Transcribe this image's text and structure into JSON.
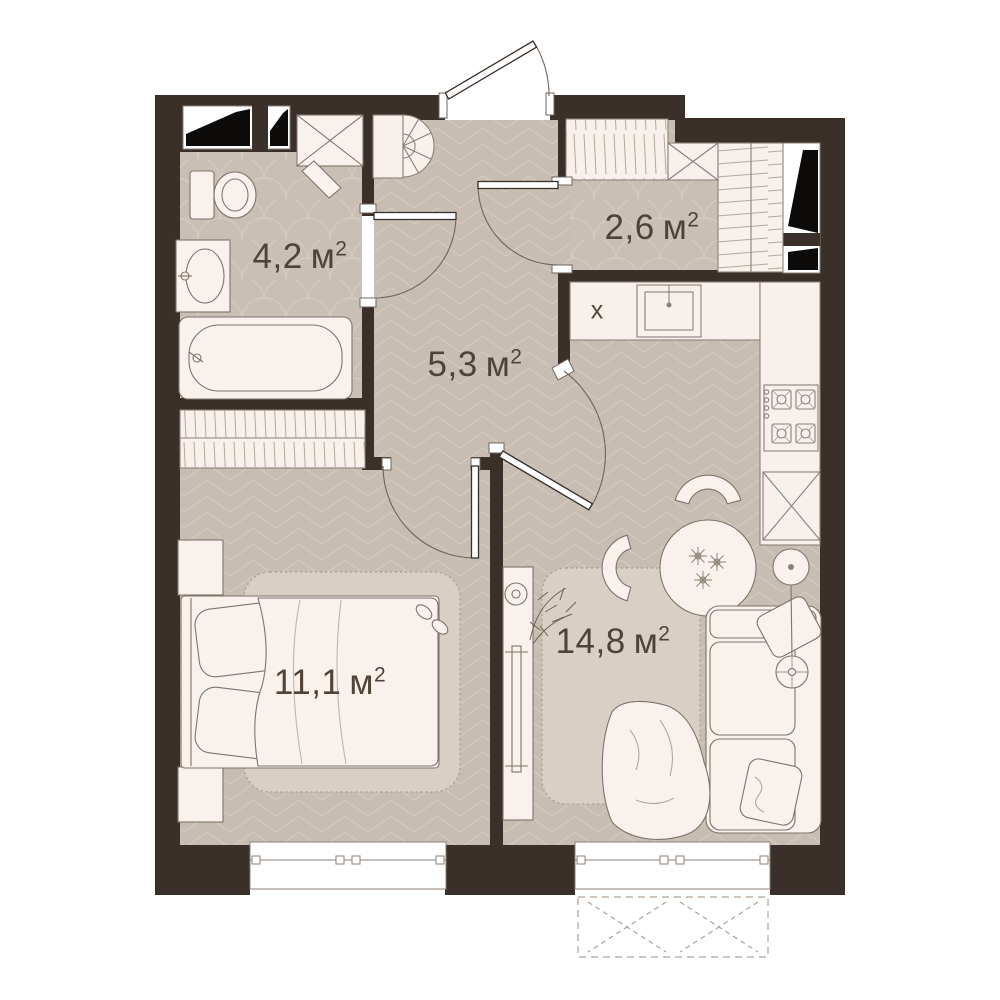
{
  "rooms": [
    {
      "id": "bathroom",
      "area": "4,2",
      "unit": "м",
      "exp": "2"
    },
    {
      "id": "wardrobe-hall",
      "area": "2,6",
      "unit": "м",
      "exp": "2"
    },
    {
      "id": "hallway",
      "area": "5,3",
      "unit": "м",
      "exp": "2"
    },
    {
      "id": "bedroom",
      "area": "11,1",
      "unit": "м",
      "exp": "2"
    },
    {
      "id": "living-kitchen",
      "area": "14,8",
      "unit": "м",
      "exp": "2"
    }
  ],
  "kitchen": {
    "fridge_mark": "x"
  },
  "colors": {
    "wall": "#3a3029",
    "floor": "#c7bdb2",
    "floor_line": "#d3c9be",
    "furniture": "#f8f1ec",
    "outline": "#7f746b",
    "rug": "#d8d0c5",
    "label": "#4f4337",
    "shaft_black": "#0d0b09"
  }
}
